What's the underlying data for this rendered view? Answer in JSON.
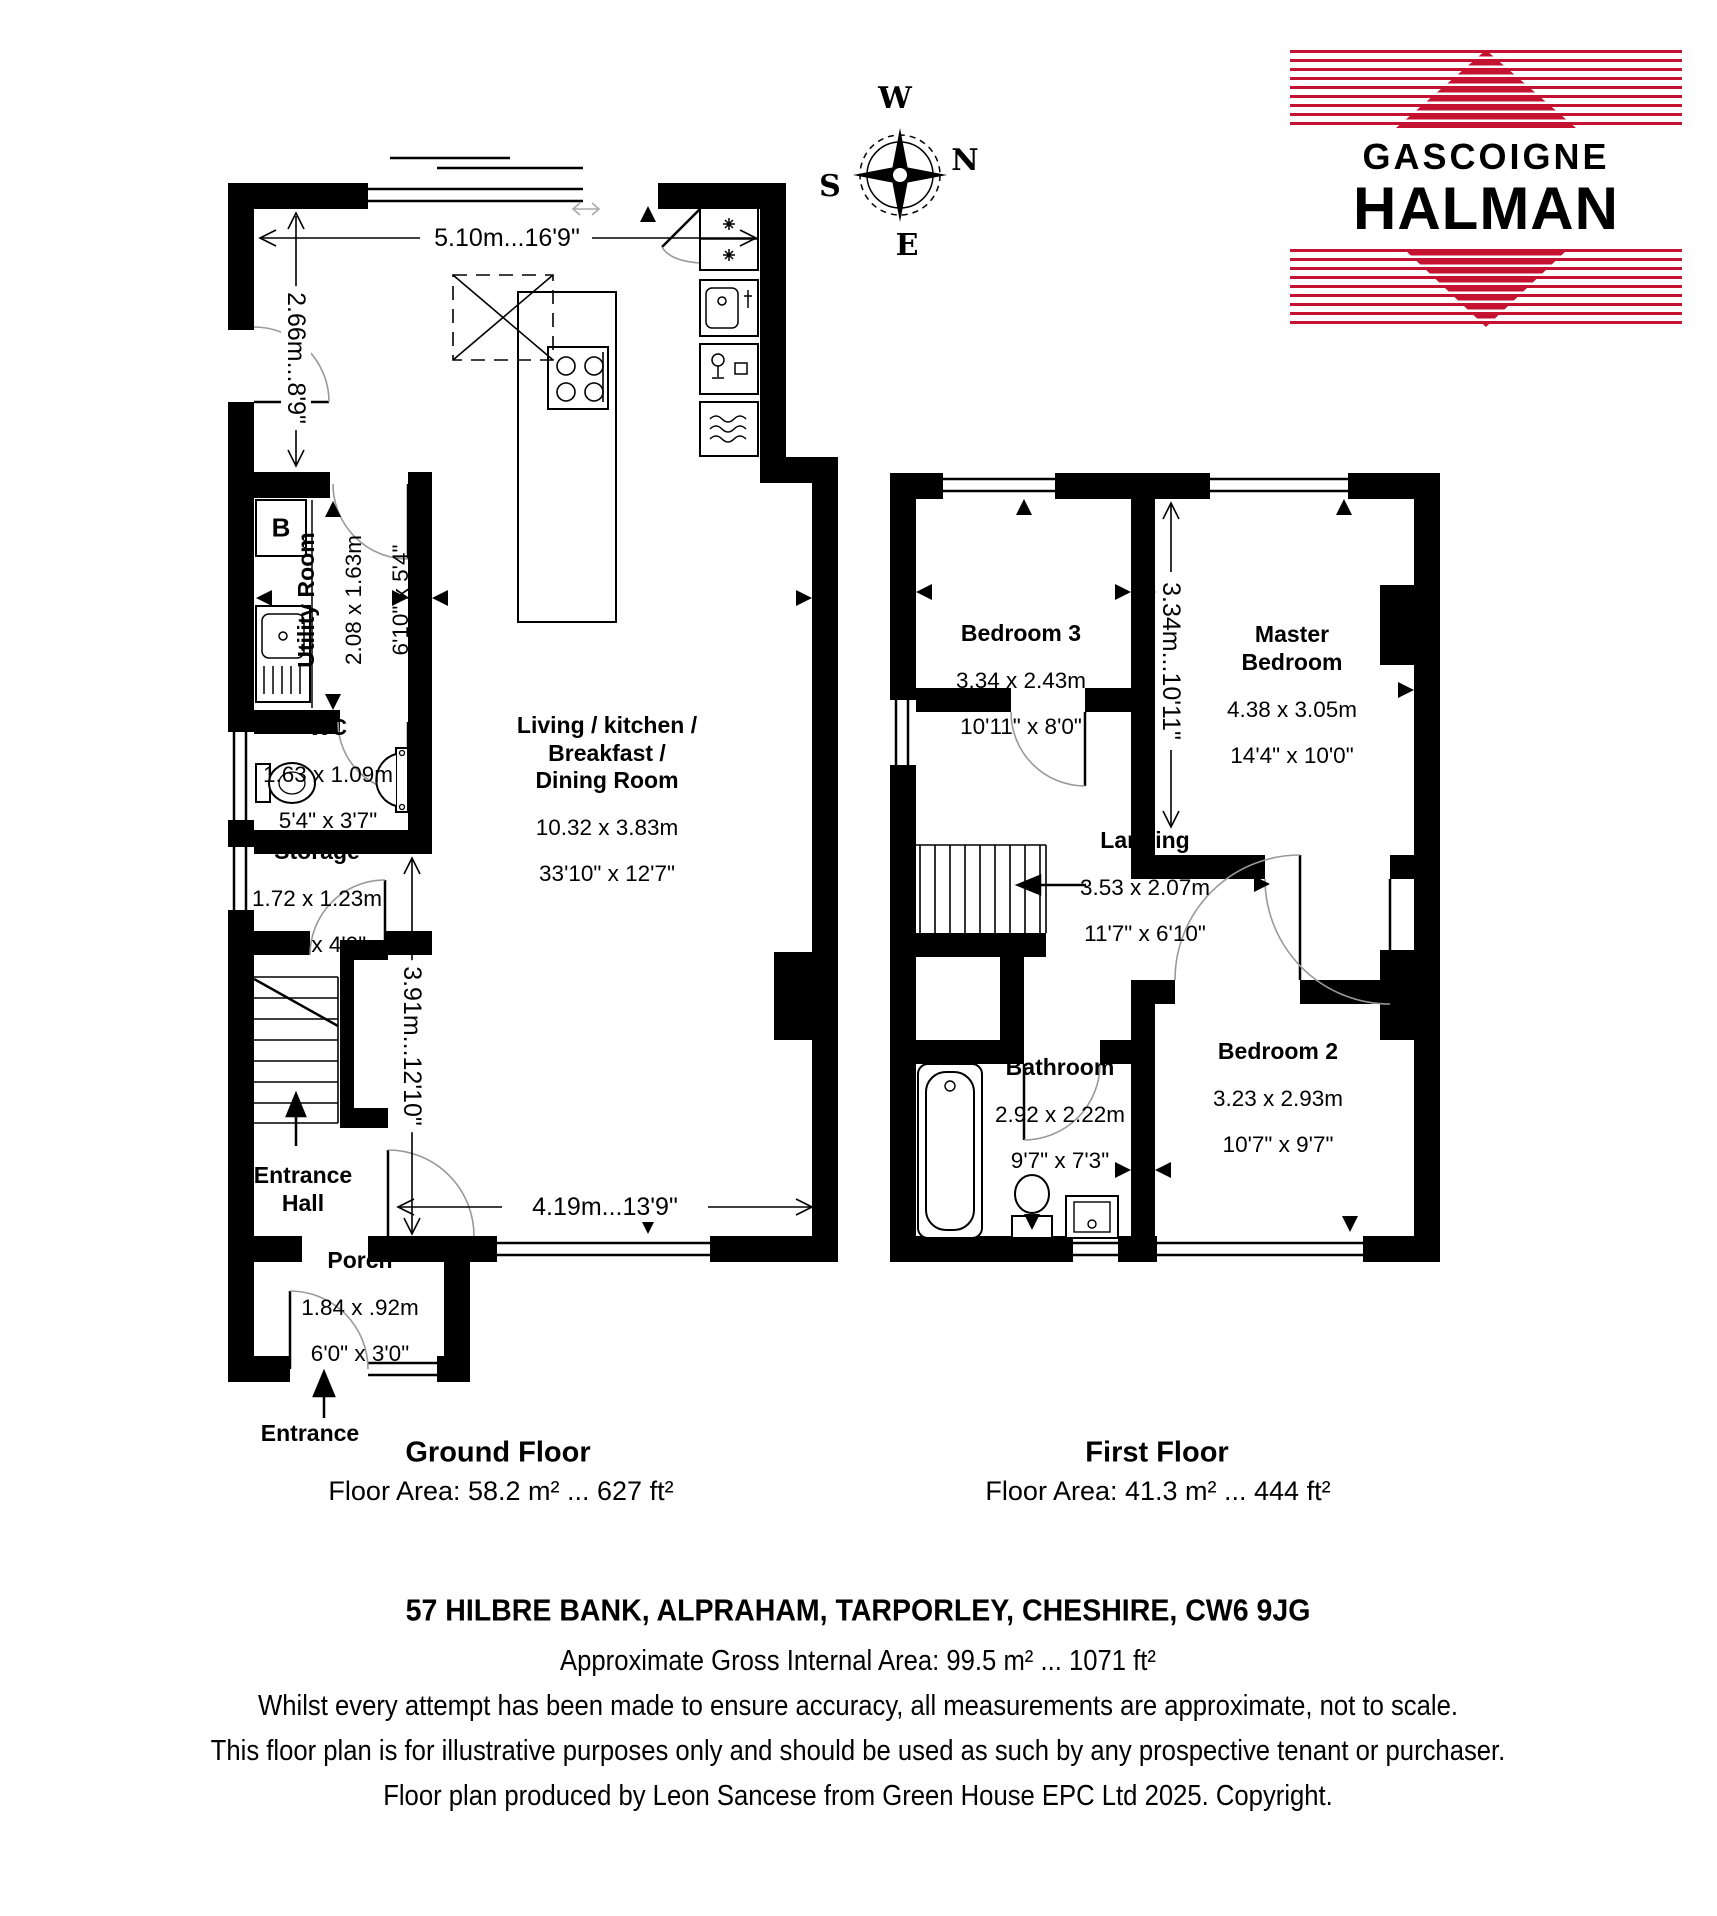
{
  "compass": {
    "west": "W",
    "north": "N",
    "south": "S",
    "east": "E"
  },
  "logo": {
    "top_word": "GASCOIGNE",
    "bottom_word": "HALMAN",
    "brand_red": "#c41230"
  },
  "ground_floor": {
    "title": "Ground Floor",
    "floor_area": "Floor Area: 58.2 m² ... 627 ft²",
    "entrance_label": "Entrance",
    "boiler_label": "B",
    "dimensions": {
      "top_width": "5.10m...16'9\"",
      "kitchen_depth": "2.66m...8'9\"",
      "hall_height": "3.91m...12'10\"",
      "living_width": "4.19m...13'9\""
    },
    "rooms": {
      "living": {
        "name": "Living / kitchen /\nBreakfast /\nDining Room",
        "metric": "10.32 x 3.83m",
        "imperial": "33'10\" x 12'7\""
      },
      "utility": {
        "name": "Utility Room",
        "metric": "2.08 x 1.63m",
        "imperial": "6'10\" x 5'4\""
      },
      "wc": {
        "name": "WC",
        "metric": "1.63 x 1.09m",
        "imperial": "5'4\" x 3'7\""
      },
      "storage": {
        "name": "Storage",
        "metric": "1.72 x 1.23m",
        "imperial": "5'8\" x 4'0\""
      },
      "entrance_hall": {
        "name": "Entrance\nHall"
      },
      "porch": {
        "name": "Porch",
        "metric": "1.84 x .92m",
        "imperial": "6'0\" x 3'0\""
      }
    }
  },
  "first_floor": {
    "title": "First Floor",
    "floor_area": "Floor Area: 41.3 m² ... 444 ft²",
    "dimensions": {
      "bedrooms_depth": "3.34m...10'11\""
    },
    "rooms": {
      "bedroom3": {
        "name": "Bedroom 3",
        "metric": "3.34 x 2.43m",
        "imperial": "10'11\" x 8'0\""
      },
      "master": {
        "name": "Master\nBedroom",
        "metric": "4.38 x 3.05m",
        "imperial": "14'4\" x 10'0\""
      },
      "landing": {
        "name": "Landing",
        "metric": "3.53 x 2.07m",
        "imperial": "11'7\" x 6'10\""
      },
      "bathroom": {
        "name": "Bathroom",
        "metric": "2.92 x 2.22m",
        "imperial": "9'7\" x 7'3\""
      },
      "bedroom2": {
        "name": "Bedroom 2",
        "metric": "3.23 x 2.93m",
        "imperial": "10'7\" x 9'7\""
      }
    }
  },
  "footer": {
    "address": "57 HILBRE BANK, ALPRAHAM, TARPORLEY, CHESHIRE, CW6 9JG",
    "gross_area": "Approximate Gross Internal Area: 99.5 m² ... 1071 ft²",
    "disclaimer_line1": "Whilst every attempt has been made to ensure accuracy, all measurements are approximate, not to scale.",
    "disclaimer_line2": "This floor plan is for illustrative purposes only and should be used as such by any prospective tenant or purchaser.",
    "credit": "Floor plan produced by Leon Sancese from Green House EPC Ltd 2025. Copyright."
  }
}
